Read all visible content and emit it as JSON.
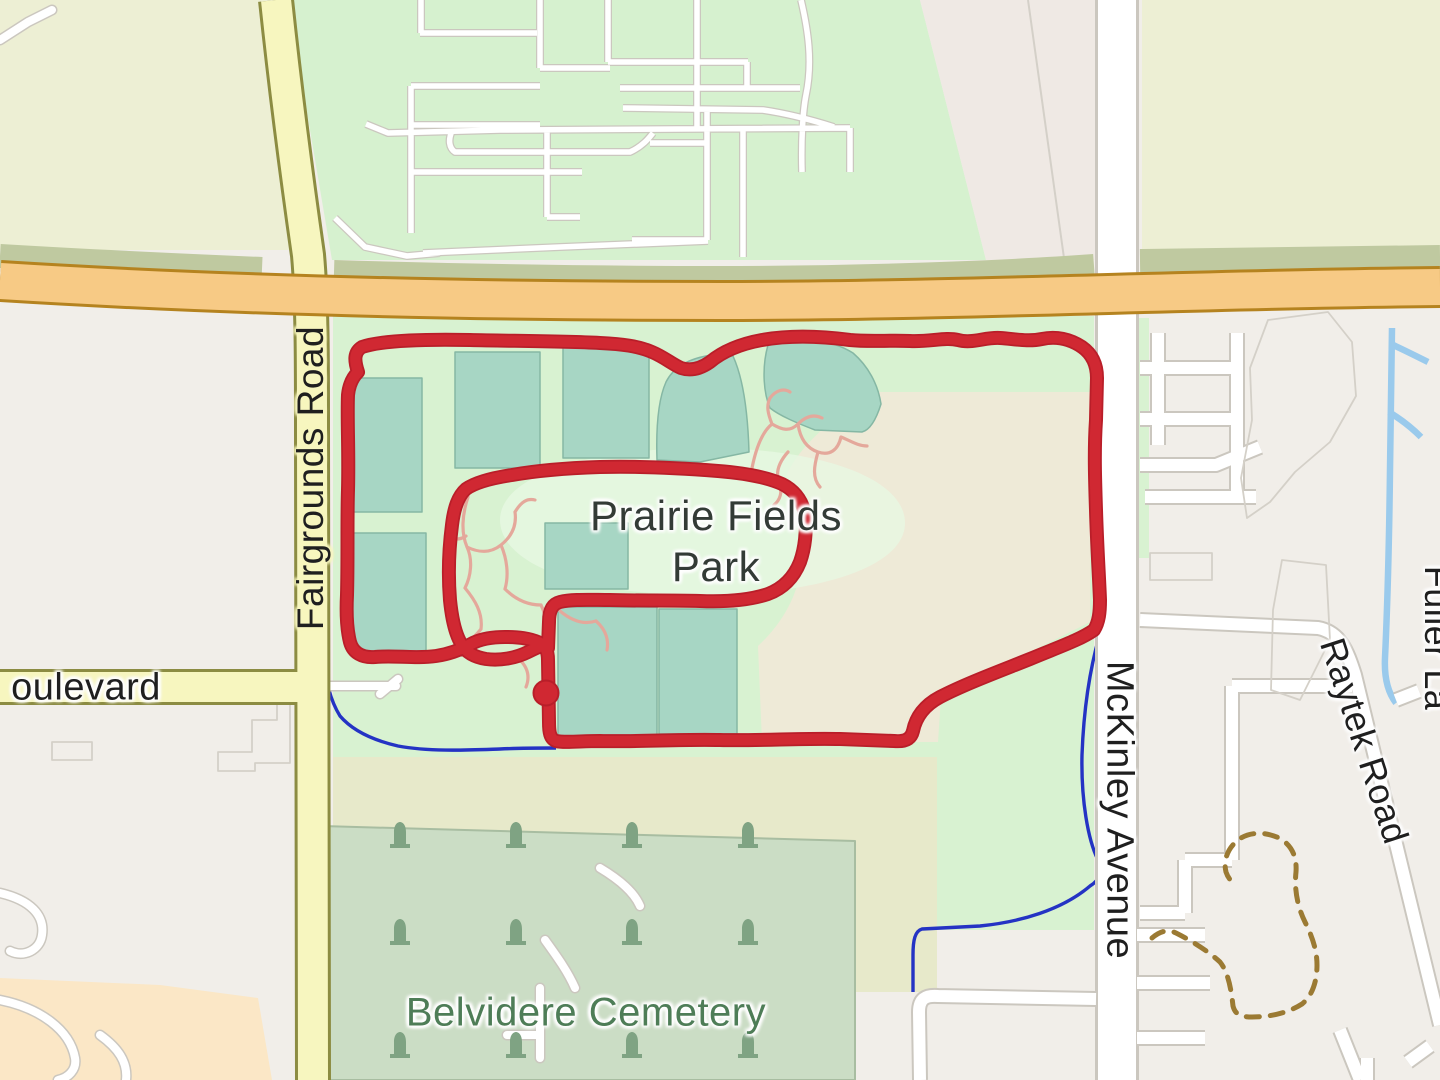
{
  "meta": {
    "description": "OpenStreetMap-style map with red GPS activity route around Prairie Fields Park",
    "canvas": {
      "w": 1440,
      "h": 1080
    }
  },
  "palette": {
    "base": "#f1eee9",
    "olive": "#edefd4",
    "olive_band": "#bfc9a0",
    "green_res": "#d6f1cf",
    "strip_gray": "#efe9e4",
    "park": "#d8f2d1",
    "farmland": "#eeead7",
    "band": "#e7e9ca",
    "cemetery": "#cbddc5",
    "cemetery_edge": "#a8bda1",
    "peach": "#fbe7c6",
    "pitch": "#a7d6c4",
    "pitch_edge": "#85b7a4",
    "white_road": "#ffffff",
    "road_casing": "#cbc7bf",
    "yellow_road": "#f7f6bf",
    "yellow_casing": "#8c8c42",
    "orange_road": "#f7ca85",
    "orange_casing": "#b5831f",
    "water_dark": "#2433c4",
    "water_light": "#9acaec",
    "pink": "#e4a89b",
    "red": "#d02832",
    "red_dark": "#b91e29",
    "trail": "#9b7a33",
    "gray_line": "#d4d0c8",
    "tombstone": "#7fa383",
    "label_dark": "#1f1f1f",
    "label_park": "#333b36",
    "label_green": "#4e7d57",
    "halo": "#ffffff",
    "halo_yellow": "#f7f6bf",
    "glow_green": "#e7f8e2"
  },
  "labels": {
    "park": {
      "text": "Prairie Fields Park",
      "x": 716,
      "y": 541,
      "size": 42,
      "color": "$label_park",
      "rotate": 0,
      "w": 340,
      "halo": "$halo"
    },
    "cemetery": {
      "text": "Belvidere Cemetery",
      "x": 586,
      "y": 1013,
      "size": 40,
      "color": "$label_green",
      "rotate": 0,
      "halo": "$halo"
    },
    "fairgrounds": {
      "text": "Fairgrounds Road",
      "x": 311,
      "y": 478,
      "size": 37,
      "color": "$label_dark",
      "rotate": -90,
      "halo": "$halo_yellow"
    },
    "boulevard": {
      "text": "oulevard",
      "x": 86,
      "y": 688,
      "size": 38,
      "color": "$label_dark",
      "rotate": 0,
      "halo": "$halo"
    },
    "mckinley": {
      "text": "McKinley Avenue",
      "x": 1119,
      "y": 810,
      "size": 38,
      "color": "$label_dark",
      "rotate": 90,
      "halo": "$halo"
    },
    "raytek": {
      "text": "Raytek Road",
      "x": 1364,
      "y": 741,
      "size": 36,
      "color": "$label_dark",
      "rotate": 72,
      "halo": "$halo"
    },
    "fuller": {
      "text": "Fuller La",
      "x": 1437,
      "y": 638,
      "size": 36,
      "color": "$label_dark",
      "rotate": 90,
      "halo": "$halo"
    }
  },
  "route_marker": {
    "x": 546,
    "y": 693,
    "r": 12.5
  },
  "layers": [
    {
      "n": "base-land",
      "d": "M0,0H1440V1080H0Z",
      "f": "$base"
    },
    {
      "n": "fairground-area-topleft",
      "d": "M0,0 L272,0 C282,90 294,175 305,250 L0,250 Z",
      "f": "$olive"
    },
    {
      "n": "field-area-topright",
      "d": "M1142,0 H1440 V272 H1142 Z",
      "f": "$olive"
    },
    {
      "n": "residential-green-area",
      "d": "M288,0 L920,0 L986,260 L332,260 Z",
      "f": "$green_res"
    },
    {
      "n": "gray-strip-top",
      "d": "M920,0 L1096,0 L1096,260 L986,260 Z",
      "f": "$strip_gray"
    },
    {
      "n": "gray-strip-divider",
      "d": "M1028,0 L1064,258",
      "s": "$gray_line",
      "w": 2
    },
    {
      "n": "park-green-area",
      "d": "M333,316 H1094 V930 H937 V757 H333 Z",
      "f": "$park"
    },
    {
      "n": "park-sliver-east",
      "d": "M1139,318 h10 v240 h-10 Z",
      "f": "$park"
    },
    {
      "n": "farmland-area",
      "d": "M872,392 L1090,392 L1090,622 C1050,642 990,672 941,697 L938,742 L762,742 L758,646 C788,618 801,587 803,552 C805,522 798,494 787,474 C800,446 832,418 872,392 Z",
      "f": "$farmland"
    },
    {
      "n": "scrub-band-1",
      "d": "M333,757 H937 V845 H333 Z",
      "f": "$band"
    },
    {
      "n": "scrub-band-2",
      "d": "M855,845 H937 V992 H855 Z",
      "f": "$band"
    },
    {
      "n": "cemetery-area",
      "d": "M322,826 L855,841 L855,1080 L322,1080 Z",
      "f": "$cemetery",
      "s": "$cemetery_edge",
      "w": 2
    },
    {
      "n": "peach-area-bottomleft",
      "d": "M0,978 L160,985 L258,998 L272,1080 L0,1080 Z",
      "f": "$peach"
    },
    {
      "n": "park-label-glow",
      "d": "M500,520 C500,475 590,448 705,448 C820,448 905,478 905,523 C905,568 815,595 700,595 C585,595 500,565 500,520 Z",
      "f": "$glow_green",
      "o": 0.8
    },
    {
      "n": "stream-dark",
      "d": "M322,650 C326,682 330,700 340,716 C352,730 372,740 398,746 C430,752 470,750 500,749 C520,748 538,748 556,748 M1113,597 C1108,608 1104,618 1101,630 C1092,660 1084,700 1082,755 C1081,800 1088,840 1098,860 C1103,870 1100,880 1090,886 C1062,910 1020,922 980,926 L922,929 C915,931 913,940 913,955 L913,992",
      "s": "$water_dark",
      "w": 3.4
    },
    {
      "n": "stream-light",
      "d": "M1392,328 L1390,470 C1389,555 1387,615 1385,658 C1384,680 1389,694 1396,703 M1391,344 C1404,350 1416,356 1428,362 M1389,412 C1402,420 1412,428 1421,437",
      "s": "$water_light",
      "w": 6.5
    },
    {
      "n": "road-casing-small-west",
      "d": "M0,40 L28,22 L52,10 M322,686 H396 M380,694 L398,679 M600,868 C620,880 634,892 640,906 M545,940 C558,958 568,972 575,988 M540,988 L540,1058 M540,1035 H507 M0,893 C30,900 45,915 42,935 C40,950 24,958 10,951 M0,1000 C40,1008 70,1030 75,1058 C77,1070 68,1078 58,1080 M100,1035 C118,1048 128,1062 126,1080",
      "s": "$road_casing",
      "w": 11,
      "cap": "round"
    },
    {
      "n": "road-casing-grid",
      "d": "M420,33 H537 M421,0 V33 M540,0 V68 M540,68 H610 M608,0 V62 M608,62 H748 M747,62 V88 M620,88 H800 M697,0 V128 M411,86 H540 M411,86 V233 M410,125 H540 M366,124 L388,133 L500,130 L850,128 M850,128 V172 M623,108 L763,110 C790,114 812,120 834,127 M452,131 C448,140 449,148 455,152 L630,152 C643,146 649,138 653,133 M650,143 H707 M412,172 H582 M547,128 V217 M547,217 H580 M707,110 V240 M632,240 H708 M743,128 V257 M801,0 C808,30 813,62 806,95 C803,110 801,140 802,172 M335,218 L365,247 L407,256 L440,253 M423,253 L560,247 L708,241",
      "s": "$road_casing",
      "w": 8
    },
    {
      "n": "road-casing-mckinley",
      "d": "M1117,0 V1080",
      "s": "$road_casing",
      "w": 44
    },
    {
      "n": "road-casing-east",
      "d": "M1158,333 V445 M1140,368 H1237 M1140,419 H1232 M1237,333 V497 M1140,465 H1216 L1260,447 M1145,497 H1256 M1140,620 L1318,628 C1340,632 1347,650 1355,675 L1440,1025 M1352,686 H1232 M1232,686 V860 M1232,860 H1185 M1185,860 V913 M1185,913 H1140 M1137,935 H1205 M1137,983 H1210 M1137,1038 H1205 M920,1080 L919,1012 C919,999 925,995 938,996 L1096,999 M1340,1030 L1360,1080 M1408,1062 L1430,1046 M1367,1058 V1080 M1396,700 L1419,691",
      "s": "$road_casing",
      "w": 16
    },
    {
      "n": "road-fill-small-west",
      "d": "M0,40 L28,22 L52,10 M322,686 H396 M380,694 L398,679 M600,868 C620,880 634,892 640,906 M545,940 C558,958 568,972 575,988 M540,988 L540,1058 M540,1035 H507 M0,893 C30,900 45,915 42,935 C40,950 24,958 10,951 M0,1000 C40,1008 70,1030 75,1058 C77,1070 68,1078 58,1080 M100,1035 C118,1048 128,1062 126,1080",
      "s": "$white_road",
      "w": 8,
      "cap": "round"
    },
    {
      "n": "road-fill-grid",
      "d": "M420,33 H537 M421,0 V33 M540,0 V68 M540,68 H610 M608,0 V62 M608,62 H748 M747,62 V88 M620,88 H800 M697,0 V128 M411,86 H540 M411,86 V233 M410,125 H540 M366,124 L388,133 L500,130 L850,128 M850,128 V172 M623,108 L763,110 C790,114 812,120 834,127 M452,131 C448,140 449,148 455,152 L630,152 C643,146 649,138 653,133 M650,143 H707 M412,172 H582 M547,128 V217 M547,217 H580 M707,110 V240 M632,240 H708 M743,128 V257 M801,0 C808,30 813,62 806,95 C803,110 801,140 802,172 M335,218 L365,247 L407,256 L440,253 M423,253 L560,247 L708,241",
      "s": "$white_road",
      "w": 5.5
    },
    {
      "n": "road-fill-mckinley",
      "d": "M1117,0 V1080",
      "s": "$white_road",
      "w": 38
    },
    {
      "n": "road-fill-east",
      "d": "M1158,333 V445 M1140,368 H1237 M1140,419 H1232 M1237,333 V497 M1140,465 H1216 L1260,447 M1145,497 H1256 M1140,620 L1318,628 C1340,632 1347,650 1355,675 L1440,1025 M1352,686 H1232 M1232,686 V860 M1232,860 H1185 M1185,860 V913 M1185,913 H1140 M1137,935 H1205 M1137,983 H1210 M1137,1038 H1205 M920,1080 L919,1012 C919,999 925,995 938,996 L1096,999 M1340,1030 L1360,1080 M1408,1062 L1430,1046 M1367,1058 V1080 M1396,700 L1419,691",
      "s": "$white_road",
      "w": 12
    },
    {
      "n": "parcel-outlines",
      "d": "M1268,320 L1328,312 L1352,342 L1356,396 L1330,442 L1295,472 L1270,502 L1247,518 L1241,478 L1252,420 L1250,368 Z M1150,553 H1212 V580 H1150 Z M1282,560 L1326,565 L1330,640 L1300,700 L1271,690 L1273,610 Z M290,702 V763 H255 V771 H218 V752 H252 V720 H277 V702 Z M52,742 H92 V760 H52 Z",
      "s": "$gray_line",
      "w": 1.8
    },
    {
      "n": "scrub-band-strip",
      "d": "M0,256 C100,262 190,266 262,269 M334,272 C500,277 640,278 718,278 C900,278 1040,270 1094,266 M1140,261 C1240,259 1340,258 1440,257",
      "s": "$olive_band",
      "w": 24
    },
    {
      "n": "road-casing-yellow",
      "d": "M276,0 C286,95 298,185 308,255 C312,300 312,360 312,430 L313,1080 M0,687 H316",
      "s": "$yellow_casing",
      "w": 36
    },
    {
      "n": "road-fill-yellow",
      "d": "M276,0 C286,95 298,185 308,255 C312,300 312,360 312,430 L313,1080 M0,687 H316",
      "s": "$yellow_road",
      "w": 30
    },
    {
      "n": "road-casing-orange",
      "d": "M0,281 C240,296 480,301 720,301 C960,301 1200,289 1440,287",
      "s": "$orange_casing",
      "w": 42
    },
    {
      "n": "road-fill-orange",
      "d": "M0,281 C240,296 480,301 720,301 C960,301 1200,289 1440,287",
      "s": "$orange_road",
      "w": 36
    },
    {
      "n": "sports-pitches",
      "d": "M352,378 H422 V512 H352 Z M352,533 H426 V652 H352 Z M455,352 H540 V468 H455 Z M563,344 H649 V458 H563 Z M545,523 H628 V589 H545 Z M558,607 H657 V738 H558 Z M659,609 H737 V734 H659 Z M657,460 C656,430 658,400 666,382 C674,366 690,358 712,355 L733,356 C744,380 748,418 749,452 L700,462 Z M768,345 C780,339 794,337 808,338 C826,341 842,346 853,353 C868,366 878,384 881,404 C876,420 870,430 862,432 L815,430 C797,423 780,416 770,408 C763,392 762,366 768,345 Z",
      "f": "$pitch",
      "s": "$pitch_edge",
      "w": 1.5
    },
    {
      "n": "park-footpaths",
      "d": "M752,468 C756,448 762,432 772,424 C768,414 766,406 770,398 C776,390 784,388 790,392 M772,424 C782,430 790,432 798,424 C806,416 814,414 822,418 M798,424 C800,438 806,448 818,452 C830,456 838,450 841,437 M818,452 C814,466 812,478 820,487 M841,437 C851,441 858,446 867,446 M788,452 C779,462 775,472 779,483 C783,492 780,500 774,505 M468,497 C462,515 461,533 467,547 C473,560 471,576 465,588 M467,547 C479,553 491,553 501,545 C511,537 517,526 515,512 M515,512 C521,502 527,498 535,500 M501,545 C507,559 509,575 505,589 M465,588 C475,600 483,613 481,629 M505,589 C515,599 527,605 541,605 M481,629 C473,639 465,645 458,648 M541,605 C547,617 547,629 543,639 M560,611 C572,621 584,625 596,621 M596,621 C605,629 609,639 607,650 M520,660 C528,668 530,677 526,687 M448,536 C454,540 460,540 466,536",
      "s": "$pink",
      "w": 3.2,
      "cap": "round"
    },
    {
      "n": "gps-route-casing",
      "d": "M358,372 C354,360 354,352 362,347 C380,341 420,339 470,340 C510,341 560,341 600,343 C622,344 638,346 652,352 C664,357 672,364 681,368 C690,371 700,369 710,362 C722,352 740,344 762,340 C790,335 820,336 850,340 C870,342 890,340 910,341 C930,342 945,337 958,340 C972,344 985,337 1000,338 C1015,339 1028,342 1042,339 C1056,336 1070,339 1082,347 C1092,354 1097,364 1097,378 L1096,420 C1094,450 1095,480 1096,510 C1097,545 1099,575 1100,600 C1100,612 1099,622 1094,630 C1080,640 1056,648 1030,659 C1000,671 965,684 940,697 C925,705 916,716 913,731 C911,739 905,742 894,741 L840,739 C800,738 760,741 720,740 C680,739 640,742 600,741 C580,741 565,743 556,741 C550,739 549,732 549,722 L548,660 C548,652 546,646 540,643 C530,638 518,637 505,637 C492,637 480,639 471,644 C462,649 450,654 436,656 C415,659 395,655 375,657 C362,658 353,653 350,642 C347,630 346,615 347,595 C348,560 347,520 348,490 C349,450 347,420 348,395 C349,385 352,378 358,372 Z M462,645 C456,636 452,620 450,600 C448,575 449,548 452,525 C454,508 458,496 466,489 C476,482 492,478 512,475 C540,470 570,468 600,467 C640,466 680,468 718,471 C744,473 766,477 782,484 C794,490 802,500 805,514 C807,530 805,548 800,562 C794,577 784,588 768,594 C750,600 725,602 700,601 C670,600 640,601 610,600 C590,600 572,599 560,602 C552,604 549,611 549,622 L548,648 M462,645 C466,652 474,657 486,659 C500,661 516,658 528,652 C536,648 542,645 547,644",
      "s": "$red_dark",
      "w": 14,
      "cap": "round"
    },
    {
      "n": "gps-route",
      "d": "M358,372 C354,360 354,352 362,347 C380,341 420,339 470,340 C510,341 560,341 600,343 C622,344 638,346 652,352 C664,357 672,364 681,368 C690,371 700,369 710,362 C722,352 740,344 762,340 C790,335 820,336 850,340 C870,342 890,340 910,341 C930,342 945,337 958,340 C972,344 985,337 1000,338 C1015,339 1028,342 1042,339 C1056,336 1070,339 1082,347 C1092,354 1097,364 1097,378 L1096,420 C1094,450 1095,480 1096,510 C1097,545 1099,575 1100,600 C1100,612 1099,622 1094,630 C1080,640 1056,648 1030,659 C1000,671 965,684 940,697 C925,705 916,716 913,731 C911,739 905,742 894,741 L840,739 C800,738 760,741 720,740 C680,739 640,742 600,741 C580,741 565,743 556,741 C550,739 549,732 549,722 L548,660 C548,652 546,646 540,643 C530,638 518,637 505,637 C492,637 480,639 471,644 C462,649 450,654 436,656 C415,659 395,655 375,657 C362,658 353,653 350,642 C347,630 346,615 347,595 C348,560 347,520 348,490 C349,450 347,420 348,395 C349,385 352,378 358,372 Z M462,645 C456,636 452,620 450,600 C448,575 449,548 452,525 C454,508 458,496 466,489 C476,482 492,478 512,475 C540,470 570,468 600,467 C640,466 680,468 718,471 C744,473 766,477 782,484 C794,490 802,500 805,514 C807,530 805,548 800,562 C794,577 784,588 768,594 C750,600 725,602 700,601 C670,600 640,601 610,600 C590,600 572,599 560,602 C552,604 549,611 549,622 L548,648 M462,645 C466,652 474,657 486,659 C500,661 516,658 528,652 C536,648 542,645 547,644",
      "s": "$red",
      "w": 10.5,
      "cap": "round"
    },
    {
      "n": "gps-route-start-marker",
      "cx": 546,
      "cy": 693,
      "r": 12.5,
      "f": "$red",
      "s": "$red_dark",
      "w": 2
    },
    {
      "n": "dashed-trail",
      "d": "M1152,938 C1160,931 1168,929 1176,933 C1192,941 1208,951 1220,962 C1228,972 1231,988 1233,1006 C1235,1014 1240,1017 1252,1017 C1270,1017 1288,1013 1302,1004 C1312,996 1317,982 1317,965 C1317,950 1312,936 1305,922 C1298,908 1294,890 1296,872 C1297,857 1292,845 1279,838 C1266,832 1250,831 1238,840 C1228,848 1223,860 1226,872 C1228,878 1231,881 1234,883",
      "s": "$trail",
      "w": 5,
      "da": "13 11",
      "cap": "round"
    },
    {
      "n": "cemetery-tombstones",
      "symbol": "M-10,12 L-10,8 L-6,8 L-6,-4 C-6,-12 -2,-14 0,-14 C2,-14 6,-12 6,-4 L6,8 L10,8 L10,12 Z",
      "f": "$tombstone",
      "positions": [
        [
          400,
          836
        ],
        [
          516,
          836
        ],
        [
          632,
          836
        ],
        [
          748,
          836
        ],
        [
          400,
          933
        ],
        [
          516,
          933
        ],
        [
          632,
          933
        ],
        [
          748,
          933
        ],
        [
          400,
          1046
        ],
        [
          516,
          1046
        ],
        [
          632,
          1046
        ],
        [
          748,
          1046
        ]
      ]
    }
  ]
}
